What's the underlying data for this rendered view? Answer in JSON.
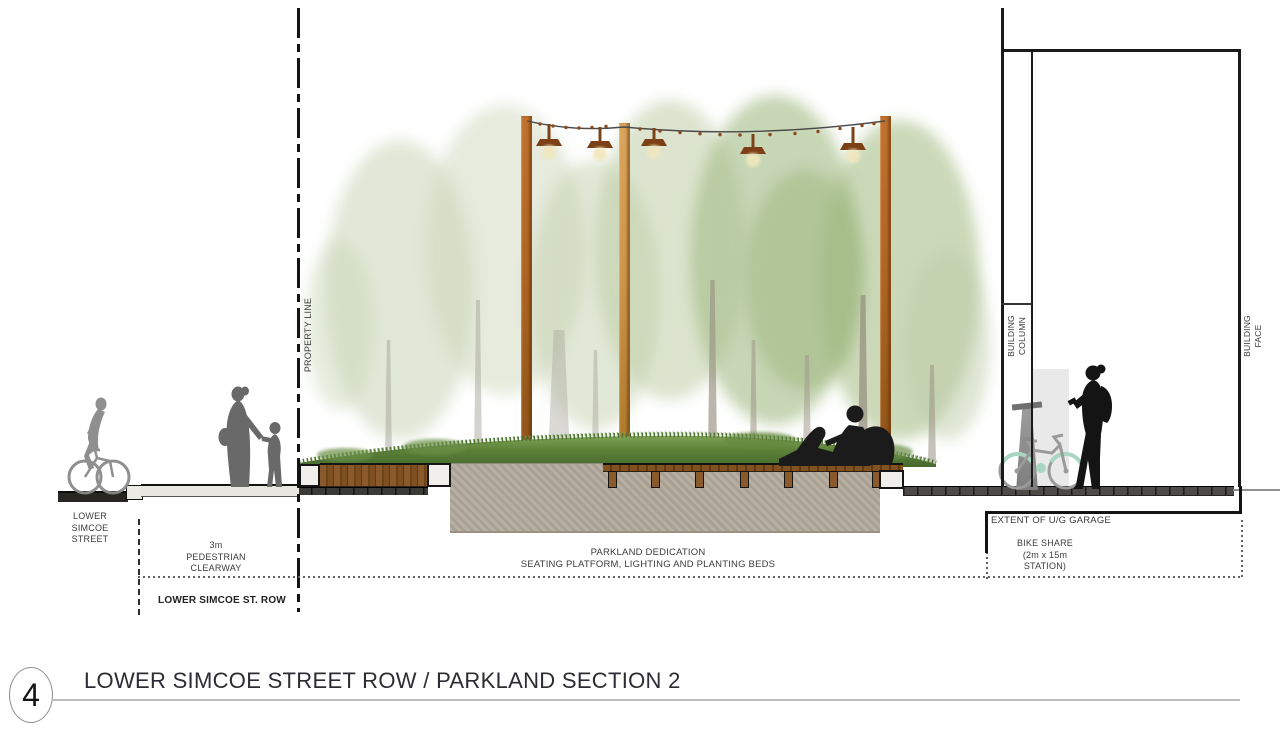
{
  "drawing": {
    "annotations": {
      "lower_simcoe_street": "LOWER\nSIMCOE\nSTREET",
      "pedestrian_clearway": "3m\nPEDESTRIAN\nCLEARWAY",
      "lower_simcoe_row": "LOWER SIMCOE ST. ROW",
      "property_line": "PROPERTY LINE",
      "parkland_dedication": "PARKLAND DEDICATION\nSEATING PLATFORM, LIGHTING AND PLANTING BEDS",
      "extent_ug_garage": "EXTENT OF U/G GARAGE",
      "bike_share": "BIKE SHARE\n(2m x 15m\nSTATION)",
      "building_column": "BUILDING\nCOLUMN",
      "building_face": "BUILDING\nFACE"
    },
    "title_block": {
      "number": "4",
      "title": "LOWER SIMCOE STREET ROW / PARKLAND SECTION 2"
    },
    "colors": {
      "wood_bench": "#84552a",
      "corten_post": "#b5702f",
      "grass": "#5d8138",
      "concrete": "#b2a99b",
      "canopy_faded": "#c2d0ae",
      "canopy_green": "#a0bb87",
      "silhouette_gray": "#8a8a8a",
      "silhouette_dark": "#1b1b1b",
      "bike_accent_mint": "#a9d6c0",
      "line_black": "#141414"
    }
  }
}
